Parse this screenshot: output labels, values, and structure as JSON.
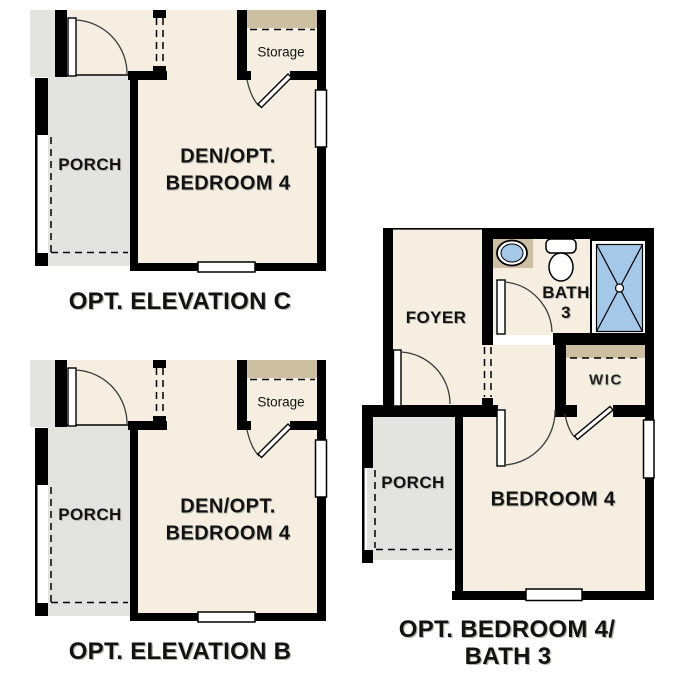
{
  "colors": {
    "background": "#ffffff",
    "wall": "#000000",
    "floor_cream": "#f5eee1",
    "porch_gray": "#e3e3e0",
    "shelf_tan": "#cdbfa2",
    "fixture_blue": "#a5c8e9",
    "label_text": "#121212"
  },
  "panels": {
    "elevation_c": {
      "caption": "OPT. ELEVATION C",
      "rooms": {
        "porch": "PORCH",
        "den_line1": "DEN/OPT.",
        "den_line2": "BEDROOM 4",
        "storage": "Storage"
      }
    },
    "elevation_b": {
      "caption": "OPT. ELEVATION B",
      "rooms": {
        "porch": "PORCH",
        "den_line1": "DEN/OPT.",
        "den_line2": "BEDROOM 4",
        "storage": "Storage"
      }
    },
    "bedroom4_bath3": {
      "caption_line1": "OPT. BEDROOM 4/",
      "caption_line2": "BATH 3",
      "rooms": {
        "foyer": "FOYER",
        "bath_line1": "BATH",
        "bath_line2": "3",
        "wic": "WIC",
        "porch": "PORCH",
        "bedroom": "BEDROOM 4"
      }
    }
  }
}
